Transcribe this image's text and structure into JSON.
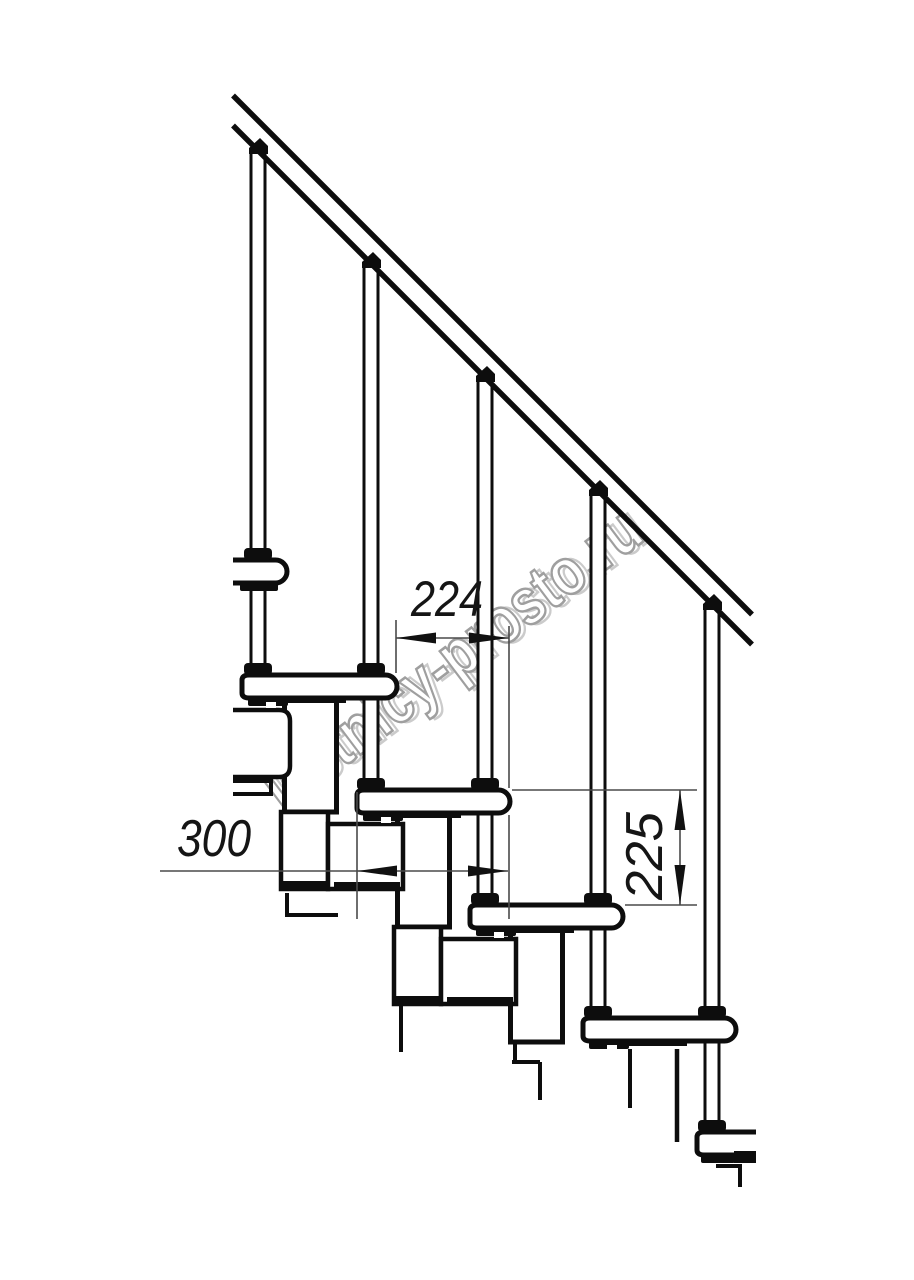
{
  "page": {
    "background": "#ffffff",
    "width": 914,
    "height": 1280
  },
  "drawing": {
    "type": "technical-drawing",
    "subject": "Side elevation of a modular staircase: inclined handrail, five balusters, six overlapping treads on a zigzag modular stringer, with dimension callouts",
    "line_color": "#0d0d0d",
    "thin_line_color": "#4a4a4a",
    "fill_color": "#ffffff"
  },
  "dimensions": [
    {
      "label": "224",
      "unit": "mm",
      "orientation": "horizontal",
      "measures": "going between adjacent tread nosings"
    },
    {
      "label": "300",
      "unit": "mm",
      "orientation": "horizontal",
      "measures": "tread depth"
    },
    {
      "label": "225",
      "unit": "mm",
      "orientation": "vertical",
      "measures": "rise between adjacent treads"
    }
  ],
  "watermark": {
    "text": "lestnicy-prosto.ru",
    "angle_deg": -37,
    "outline_color": "#9f9f9f",
    "shadow_color": "#cbcbcb"
  }
}
